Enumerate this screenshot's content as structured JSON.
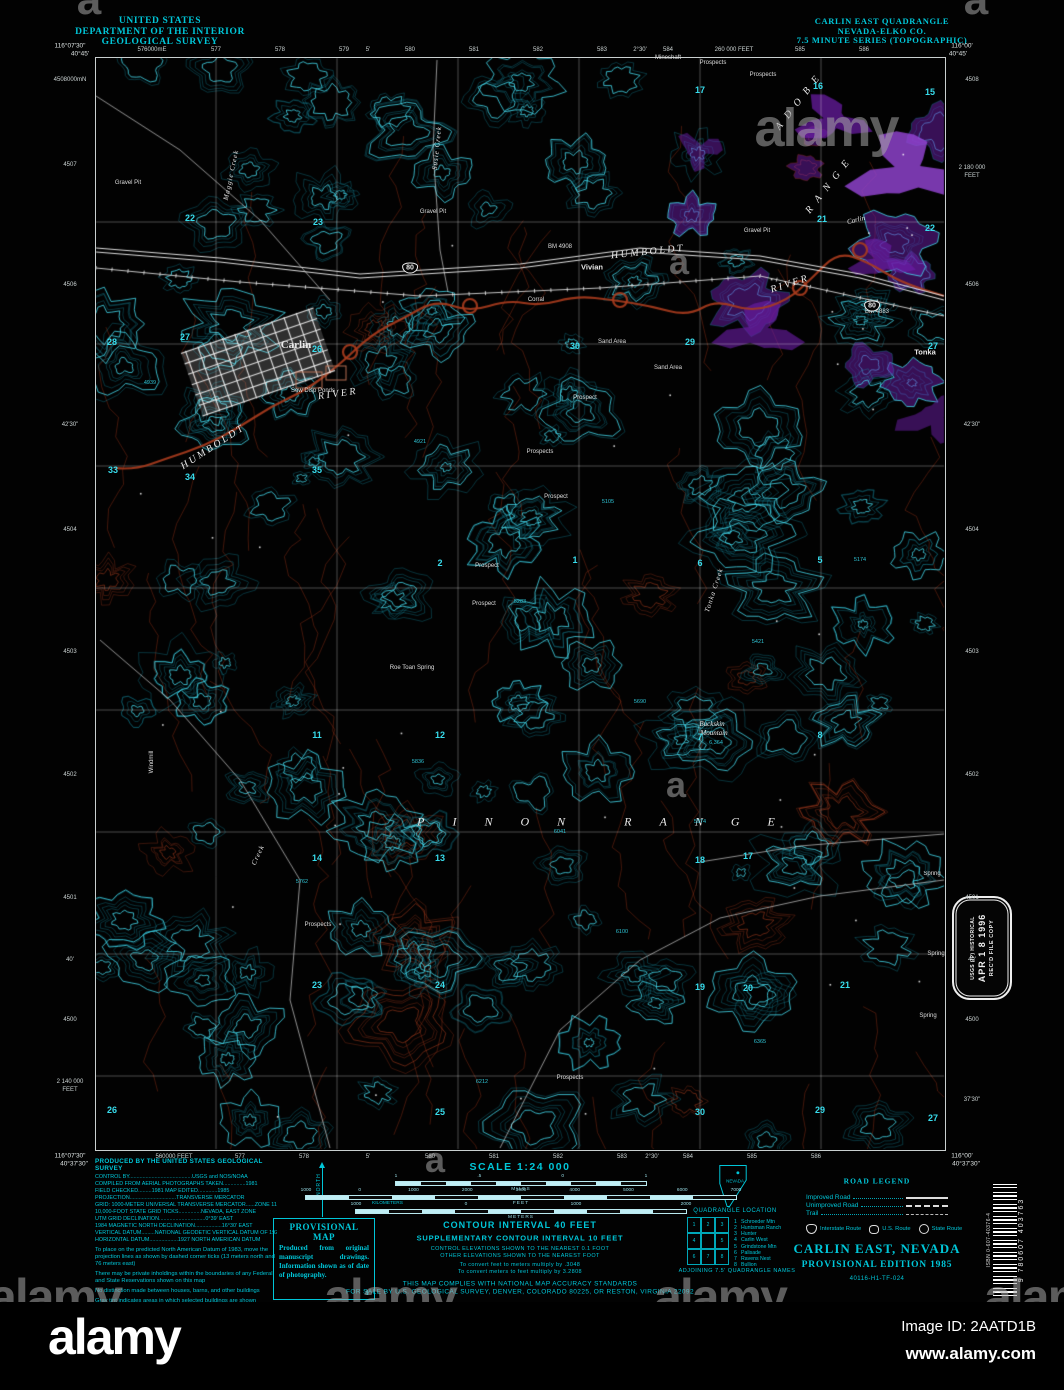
{
  "alamy": {
    "logo": "alamy",
    "image_id": "Image ID: 2AATD1B",
    "url": "www.alamy.com",
    "watermark": "alamy",
    "watermark_small": "a",
    "marks": [
      {
        "t": "alamy",
        "x": 826,
        "y": 128,
        "s": 54
      },
      {
        "t": "a",
        "x": 88,
        "y": 0,
        "s": 44
      },
      {
        "t": "a",
        "x": 975,
        "y": 0,
        "s": 44
      },
      {
        "t": "a",
        "x": 678,
        "y": 262,
        "s": 36
      },
      {
        "t": "a",
        "x": 675,
        "y": 785,
        "s": 36
      },
      {
        "t": "a",
        "x": 434,
        "y": 1160,
        "s": 36
      },
      {
        "t": "alamy",
        "x": 55,
        "y": 1297,
        "s": 50
      },
      {
        "t": "alamy",
        "x": 390,
        "y": 1297,
        "s": 50
      },
      {
        "t": "alamy",
        "x": 720,
        "y": 1297,
        "s": 50
      },
      {
        "t": "alamy",
        "x": 1050,
        "y": 1297,
        "s": 50
      }
    ]
  },
  "header": {
    "left": [
      "UNITED STATES",
      "DEPARTMENT OF THE INTERIOR",
      "GEOLOGICAL SURVEY"
    ],
    "right": [
      "CARLIN EAST QUADRANGLE",
      "NEVADA-ELKO CO.",
      "7.5 MINUTE SERIES (TOPOGRAPHIC)"
    ]
  },
  "corners": [
    {
      "t": "116°07'30\"",
      "x": 70,
      "y": 46
    },
    {
      "t": "40°45'",
      "x": 80,
      "y": 54
    },
    {
      "t": "116°00'",
      "x": 962,
      "y": 46
    },
    {
      "t": "40°45'",
      "x": 958,
      "y": 54
    },
    {
      "t": "116°07'30\"",
      "x": 70,
      "y": 1156
    },
    {
      "t": "40°37'30\"",
      "x": 74,
      "y": 1164
    },
    {
      "t": "116°00'",
      "x": 962,
      "y": 1156
    },
    {
      "t": "40°37'30\"",
      "x": 966,
      "y": 1164
    }
  ],
  "edges": {
    "top": [
      {
        "t": "576000mE",
        "x": 152
      },
      {
        "t": "577",
        "x": 216
      },
      {
        "t": "578",
        "x": 280
      },
      {
        "t": "579",
        "x": 344
      },
      {
        "t": "5'",
        "x": 368
      },
      {
        "t": "580",
        "x": 410
      },
      {
        "t": "581",
        "x": 474
      },
      {
        "t": "582",
        "x": 538
      },
      {
        "t": "583",
        "x": 602
      },
      {
        "t": "2°30'",
        "x": 640
      },
      {
        "t": "584",
        "x": 668
      },
      {
        "t": "260 000 FEET",
        "x": 734
      },
      {
        "t": "585",
        "x": 800
      },
      {
        "t": "586",
        "x": 864
      }
    ],
    "bottom": [
      {
        "t": "560000 FEET",
        "x": 174
      },
      {
        "t": "577",
        "x": 240
      },
      {
        "t": "578",
        "x": 304
      },
      {
        "t": "5'",
        "x": 368
      },
      {
        "t": "580",
        "x": 430
      },
      {
        "t": "581",
        "x": 494
      },
      {
        "t": "582",
        "x": 558
      },
      {
        "t": "583",
        "x": 622
      },
      {
        "t": "2°30'",
        "x": 652
      },
      {
        "t": "584",
        "x": 688
      },
      {
        "t": "585",
        "x": 752
      },
      {
        "t": "586",
        "x": 816
      }
    ],
    "left": [
      {
        "t": "4508000mN",
        "y": 80
      },
      {
        "t": "4507",
        "y": 165
      },
      {
        "t": "4506",
        "y": 285
      },
      {
        "t": "42'30\"",
        "y": 425
      },
      {
        "t": "4504",
        "y": 530
      },
      {
        "t": "4503",
        "y": 652
      },
      {
        "t": "4502",
        "y": 775
      },
      {
        "t": "4501",
        "y": 898
      },
      {
        "t": "40'",
        "y": 960
      },
      {
        "t": "4500",
        "y": 1020
      },
      {
        "t": "2 140 000",
        "y": 1082
      },
      {
        "t": "FEET",
        "y": 1090
      }
    ],
    "right": [
      {
        "t": "4508",
        "y": 80
      },
      {
        "t": "2 180 000",
        "y": 168
      },
      {
        "t": "FEET",
        "y": 176
      },
      {
        "t": "4506",
        "y": 285
      },
      {
        "t": "42'30\"",
        "y": 425
      },
      {
        "t": "4504",
        "y": 530
      },
      {
        "t": "4503",
        "y": 652
      },
      {
        "t": "4502",
        "y": 775
      },
      {
        "t": "4501",
        "y": 898
      },
      {
        "t": "40'",
        "y": 960
      },
      {
        "t": "4500",
        "y": 1020
      },
      {
        "t": "37'30\"",
        "y": 1100
      }
    ]
  },
  "map": {
    "labels": [
      {
        "t": "Carlin",
        "x": 296,
        "y": 345,
        "c": "town"
      },
      {
        "t": "Vivian",
        "x": 592,
        "y": 267,
        "c": "place"
      },
      {
        "t": "Tonka",
        "x": 925,
        "y": 352,
        "c": "place"
      },
      {
        "t": "HUMBOLDT",
        "x": 648,
        "y": 252,
        "c": "river",
        "r": -6
      },
      {
        "t": "RIVER",
        "x": 790,
        "y": 284,
        "c": "river",
        "r": -18
      },
      {
        "t": "HUMBOLDT",
        "x": 213,
        "y": 447,
        "c": "river",
        "r": -33
      },
      {
        "t": "RIVER",
        "x": 338,
        "y": 394,
        "c": "river",
        "r": -8
      },
      {
        "t": "PINON RANGE",
        "x": 610,
        "y": 822,
        "c": "range"
      },
      {
        "t": "ADOBE",
        "x": 800,
        "y": 100,
        "c": "range2",
        "r": -52
      },
      {
        "t": "RANGE",
        "x": 830,
        "y": 184,
        "c": "range2",
        "r": -52
      },
      {
        "t": "Buckskin",
        "x": 712,
        "y": 724,
        "c": "feature"
      },
      {
        "t": "Mountain",
        "x": 714,
        "y": 733,
        "c": "feature"
      },
      {
        "t": "6,364",
        "x": 716,
        "y": 743,
        "c": "elev"
      },
      {
        "t": "Carlin",
        "x": 856,
        "y": 220,
        "c": "feature",
        "r": -14
      },
      {
        "t": "Maggie Creek",
        "x": 231,
        "y": 175,
        "c": "creek",
        "r": -78
      },
      {
        "t": "Susie Creek",
        "x": 437,
        "y": 148,
        "c": "creek",
        "r": -84
      },
      {
        "t": "Tonka Creek",
        "x": 714,
        "y": 590,
        "c": "creek",
        "r": -72
      },
      {
        "t": "Creek",
        "x": 258,
        "y": 855,
        "c": "creek",
        "r": -65
      },
      {
        "t": "Windmill",
        "x": 152,
        "y": 762,
        "c": "small",
        "r": -90
      },
      {
        "t": "Sew Disp Ponds",
        "x": 313,
        "y": 391,
        "c": "small"
      },
      {
        "t": "Gravel Pit",
        "x": 128,
        "y": 183,
        "c": "small"
      },
      {
        "t": "Gravel Pit",
        "x": 433,
        "y": 212,
        "c": "small"
      },
      {
        "t": "Gravel Pit",
        "x": 757,
        "y": 231,
        "c": "small"
      },
      {
        "t": "Sand Area",
        "x": 612,
        "y": 342,
        "c": "small"
      },
      {
        "t": "Sand Area",
        "x": 668,
        "y": 368,
        "c": "small"
      },
      {
        "t": "Corral",
        "x": 536,
        "y": 300,
        "c": "small"
      },
      {
        "t": "Mineshaft",
        "x": 668,
        "y": 58,
        "c": "small"
      },
      {
        "t": "Prospects",
        "x": 713,
        "y": 63,
        "c": "small"
      },
      {
        "t": "Prospects",
        "x": 763,
        "y": 75,
        "c": "small"
      },
      {
        "t": "Prospect",
        "x": 585,
        "y": 398,
        "c": "small"
      },
      {
        "t": "Prospects",
        "x": 540,
        "y": 452,
        "c": "small"
      },
      {
        "t": "Prospect",
        "x": 556,
        "y": 497,
        "c": "small"
      },
      {
        "t": "Prospect",
        "x": 487,
        "y": 566,
        "c": "small"
      },
      {
        "t": "Prospect",
        "x": 484,
        "y": 604,
        "c": "small"
      },
      {
        "t": "Prospects",
        "x": 318,
        "y": 925,
        "c": "small"
      },
      {
        "t": "Prospects",
        "x": 570,
        "y": 1078,
        "c": "small"
      },
      {
        "t": "Roe Toan Spring",
        "x": 412,
        "y": 668,
        "c": "small"
      },
      {
        "t": "Spring",
        "x": 932,
        "y": 874,
        "c": "small"
      },
      {
        "t": "Spring",
        "x": 936,
        "y": 954,
        "c": "small"
      },
      {
        "t": "Spring",
        "x": 928,
        "y": 1016,
        "c": "small"
      },
      {
        "t": "BM 4908",
        "x": 560,
        "y": 247,
        "c": "small"
      },
      {
        "t": "BM 4883",
        "x": 877,
        "y": 312,
        "c": "small"
      },
      {
        "t": "80",
        "x": 410,
        "y": 268,
        "c": "shield"
      },
      {
        "t": "80",
        "x": 872,
        "y": 306,
        "c": "shield"
      },
      {
        "t": "17",
        "x": 700,
        "y": 90,
        "c": "num"
      },
      {
        "t": "16",
        "x": 818,
        "y": 86,
        "c": "num"
      },
      {
        "t": "15",
        "x": 930,
        "y": 92,
        "c": "num"
      },
      {
        "t": "22",
        "x": 190,
        "y": 218,
        "c": "num"
      },
      {
        "t": "23",
        "x": 318,
        "y": 222,
        "c": "num"
      },
      {
        "t": "21",
        "x": 822,
        "y": 219,
        "c": "num"
      },
      {
        "t": "22",
        "x": 930,
        "y": 228,
        "c": "num"
      },
      {
        "t": "28",
        "x": 112,
        "y": 342,
        "c": "num"
      },
      {
        "t": "27",
        "x": 185,
        "y": 337,
        "c": "num"
      },
      {
        "t": "26",
        "x": 317,
        "y": 349,
        "c": "num"
      },
      {
        "t": "30",
        "x": 575,
        "y": 346,
        "c": "num"
      },
      {
        "t": "29",
        "x": 690,
        "y": 342,
        "c": "num"
      },
      {
        "t": "27",
        "x": 933,
        "y": 346,
        "c": "num"
      },
      {
        "t": "33",
        "x": 113,
        "y": 470,
        "c": "num"
      },
      {
        "t": "34",
        "x": 190,
        "y": 477,
        "c": "num"
      },
      {
        "t": "35",
        "x": 317,
        "y": 470,
        "c": "num"
      },
      {
        "t": "2",
        "x": 440,
        "y": 563,
        "c": "num"
      },
      {
        "t": "1",
        "x": 575,
        "y": 560,
        "c": "num"
      },
      {
        "t": "6",
        "x": 700,
        "y": 563,
        "c": "num"
      },
      {
        "t": "5",
        "x": 820,
        "y": 560,
        "c": "num"
      },
      {
        "t": "11",
        "x": 317,
        "y": 735,
        "c": "num"
      },
      {
        "t": "12",
        "x": 440,
        "y": 735,
        "c": "num"
      },
      {
        "t": "7",
        "x": 700,
        "y": 737,
        "c": "num"
      },
      {
        "t": "8",
        "x": 820,
        "y": 735,
        "c": "num"
      },
      {
        "t": "14",
        "x": 317,
        "y": 858,
        "c": "num"
      },
      {
        "t": "13",
        "x": 440,
        "y": 858,
        "c": "num"
      },
      {
        "t": "18",
        "x": 700,
        "y": 860,
        "c": "num"
      },
      {
        "t": "17",
        "x": 748,
        "y": 856,
        "c": "num"
      },
      {
        "t": "23",
        "x": 317,
        "y": 985,
        "c": "num"
      },
      {
        "t": "24",
        "x": 440,
        "y": 985,
        "c": "num"
      },
      {
        "t": "19",
        "x": 700,
        "y": 987,
        "c": "num"
      },
      {
        "t": "20",
        "x": 748,
        "y": 988,
        "c": "num"
      },
      {
        "t": "21",
        "x": 845,
        "y": 985,
        "c": "num"
      },
      {
        "t": "26",
        "x": 112,
        "y": 1110,
        "c": "num"
      },
      {
        "t": "25",
        "x": 440,
        "y": 1112,
        "c": "num"
      },
      {
        "t": "30",
        "x": 700,
        "y": 1112,
        "c": "num"
      },
      {
        "t": "29",
        "x": 820,
        "y": 1110,
        "c": "num"
      },
      {
        "t": "27",
        "x": 933,
        "y": 1118,
        "c": "num"
      },
      {
        "t": "4939",
        "x": 150,
        "y": 383,
        "c": "elev"
      },
      {
        "t": "4921",
        "x": 420,
        "y": 442,
        "c": "elev"
      },
      {
        "t": "5105",
        "x": 608,
        "y": 502,
        "c": "elev"
      },
      {
        "t": "5283",
        "x": 520,
        "y": 602,
        "c": "elev"
      },
      {
        "t": "5421",
        "x": 758,
        "y": 642,
        "c": "elev"
      },
      {
        "t": "5690",
        "x": 640,
        "y": 702,
        "c": "elev"
      },
      {
        "t": "5836",
        "x": 418,
        "y": 762,
        "c": "elev"
      },
      {
        "t": "6041",
        "x": 560,
        "y": 832,
        "c": "elev"
      },
      {
        "t": "5974",
        "x": 700,
        "y": 822,
        "c": "elev"
      },
      {
        "t": "5762",
        "x": 302,
        "y": 882,
        "c": "elev"
      },
      {
        "t": "6100",
        "x": 622,
        "y": 932,
        "c": "elev"
      },
      {
        "t": "6365",
        "x": 760,
        "y": 1042,
        "c": "elev"
      },
      {
        "t": "6212",
        "x": 482,
        "y": 1082,
        "c": "elev"
      },
      {
        "t": "5174",
        "x": 860,
        "y": 560,
        "c": "elev"
      }
    ]
  },
  "credits": {
    "title": "PRODUCED BY THE UNITED STATES GEOLOGICAL SURVEY",
    "lines": [
      "CONTROL BY..........................................USGS and NOS/NOAA",
      "COMPILED FROM AERIAL PHOTOGRAPHS TAKEN...............1981",
      "FIELD CHECKED.........1981      MAP EDITED.............1985",
      "PROJECTION...............................TRANSVERSE MERCATOR",
      "GRID: 1000-METER UNIVERSAL TRANSVERSE MERCATOR......ZONE 11",
      "10,000-FOOT STATE GRID TICKS...............NEVADA, EAST ZONE",
      "UTM GRID DECLINATION...............................0°39' EAST",
      "1984 MAGNETIC NORTH DECLINATION..................16°30' EAST",
      "VERTICAL DATUM.........NATIONAL GEODETIC VERTICAL DATUM OF 1929",
      "HORIZONTAL DATUM...................1927 NORTH AMERICAN DATUM"
    ],
    "paragraphs": [
      "To place on the predicted North American Datum of 1983, move the projection lines as shown by dashed corner ticks (13 meters north and 76 meters east)",
      "There may be private inholdings within the boundaries of any Federal and State Reservations shown on this map",
      "No distinction made between houses, barns, and other buildings",
      "Gray tint indicates areas in which selected buildings are shown"
    ]
  },
  "declination": {
    "north": "NORTH"
  },
  "provisional": {
    "title": "PROVISIONAL MAP",
    "body": "Produced from original manuscript drawings. Information shown as of date of photography.",
    "page": "1"
  },
  "scale": {
    "title": "SCALE 1:24 000",
    "kilometers_label": "KILOMETERS",
    "bars": [
      {
        "ticks": [
          "1",
          ".5",
          "0",
          "1"
        ],
        "unit": "MILES",
        "w": 250
      },
      {
        "ticks": [
          "1000",
          "0",
          "1000",
          "2000",
          "3000",
          "4000",
          "5000",
          "6000",
          "7000"
        ],
        "unit": "FEET",
        "w": 430
      },
      {
        "ticks": [
          "1000",
          "0",
          "1000",
          "2000"
        ],
        "unit": "METERS",
        "w": 330
      }
    ],
    "contour": "CONTOUR INTERVAL 40 FEET",
    "supplementary": "SUPPLEMENTARY CONTOUR INTERVAL 10 FEET",
    "notes": [
      "CONTROL ELEVATIONS SHOWN TO THE NEAREST 0.1 FOOT",
      "OTHER ELEVATIONS SHOWN TO THE NEAREST FOOT",
      "To convert feet to meters multiply by .3048",
      "To convert meters to feet multiply by 3.2808"
    ],
    "compliance": [
      "THIS MAP COMPLIES WITH NATIONAL MAP ACCURACY STANDARDS",
      "FOR SALE BY U.S. GEOLOGICAL SURVEY, DENVER, COLORADO 80225, OR RESTON, VIRGINIA 22092"
    ]
  },
  "location": {
    "state": "NEVADA",
    "caption": "QUADRANGLE LOCATION"
  },
  "adjoining": {
    "caption": "ADJOINING 7.5' QUADRANGLE NAMES",
    "cells": [
      "1",
      "2",
      "3",
      "4",
      "",
      "5",
      "6",
      "7",
      "8"
    ],
    "names": [
      "Schroeder Mtn",
      "Huntsman Ranch",
      "Hunter",
      "Carlin West",
      "Grindstone Mtn",
      "Palisade",
      "Ravens Nest",
      "Bullion"
    ]
  },
  "road_legend": {
    "title": "ROAD LEGEND",
    "rows": [
      {
        "label": "Improved Road",
        "style": "solid"
      },
      {
        "label": "Unimproved Road",
        "style": "dashed"
      },
      {
        "label": "Trail",
        "style": "trail"
      }
    ],
    "routes": [
      {
        "label": "Interstate Route",
        "shape": "interstate"
      },
      {
        "label": "U.S. Route",
        "shape": "us"
      },
      {
        "label": "State Route",
        "shape": "state"
      }
    ]
  },
  "title_block": {
    "name": "CARLIN EAST, NEVADA",
    "edition": "PROVISIONAL EDITION 1985",
    "code": "40116-H1-TF-024"
  },
  "stamp": {
    "line1": "USGS (IP) HISTORICAL",
    "date": "APR 1 8 1996",
    "line3": "REC'D FILE COPY"
  },
  "barcode": {
    "isbn": "ISBN 0-607-40376-4",
    "number": "9 780607 403763"
  }
}
